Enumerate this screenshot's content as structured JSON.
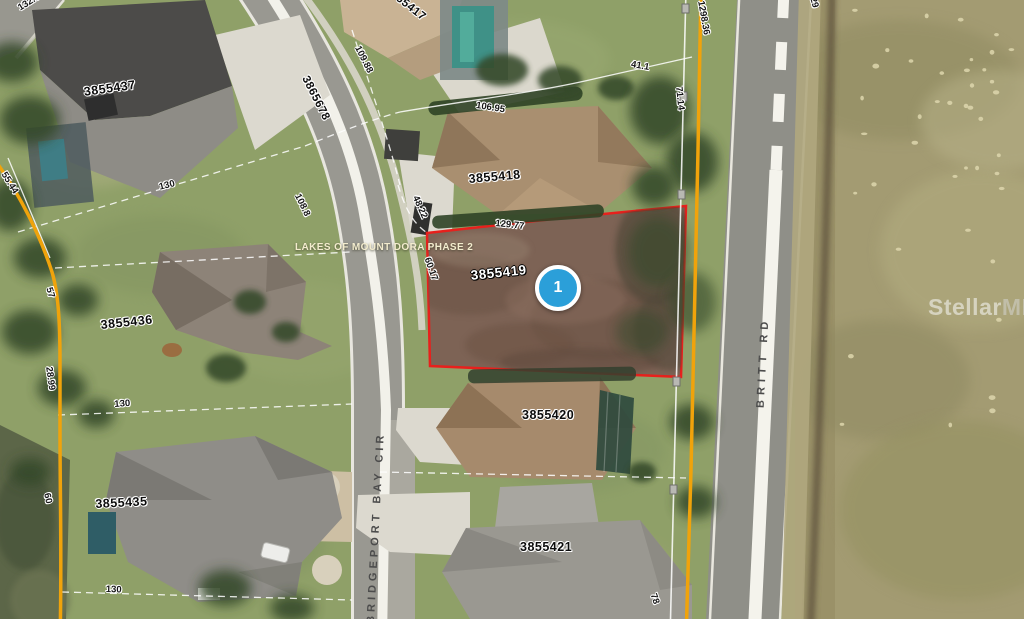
{
  "subdivision": {
    "label": "LAKES OF MOUNT DORA PHASE 2"
  },
  "marker": {
    "number": "1"
  },
  "streets": {
    "bridgeport": "BRIDGEPORT BAY CIR",
    "britt": "BRITT RD"
  },
  "watermark": {
    "brand": "Stellar",
    "suffix": "MLS"
  },
  "parcels": [
    "3855437",
    "3855436",
    "3855435",
    "3855418",
    "3855419",
    "3855420",
    "3855421",
    "3865678",
    "3855417"
  ],
  "selected_parcel": "3855419",
  "dims": [
    "132.32",
    "55.44",
    "130",
    "108.8",
    "109.88",
    "106.95",
    "41.1",
    "71.14",
    "1298.36",
    "29",
    "129.77",
    "48.22",
    "60.17",
    "57",
    "28.99",
    "130",
    "60",
    "130",
    "78"
  ],
  "colors": {
    "selected_outline": "#e8201c",
    "boundary_orange": "#f0a30b",
    "marker_blue": "#2b9fd9",
    "parcel_line_white": "#ffffff",
    "dirt_lot": "#7d6355"
  }
}
